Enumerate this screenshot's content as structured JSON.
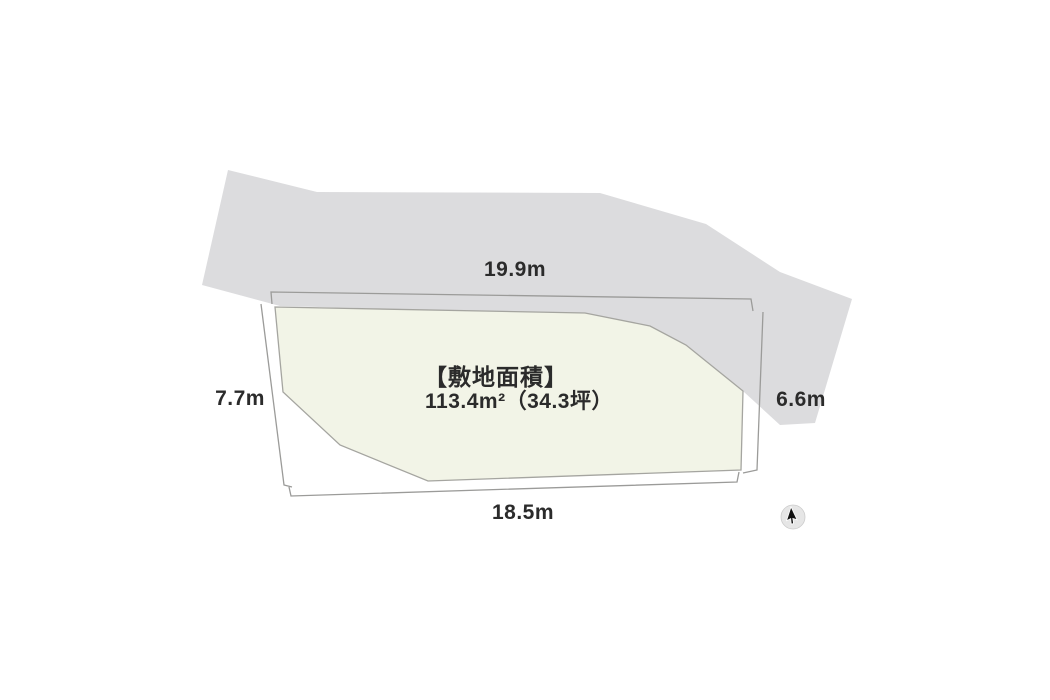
{
  "diagram": {
    "type": "land-plot-survey-diagram",
    "area_title": "【敷地面積】",
    "area_value": "113.4m²（34.3坪）",
    "dimensions": {
      "top": "19.9m",
      "left": "7.7m",
      "right": "6.6m",
      "bottom": "18.5m"
    },
    "icons": {
      "cursor": "mouse-cursor-icon"
    },
    "colors": {
      "background": "#ffffff",
      "road_fill": "#dcdcde",
      "plot_fill": "#f2f4e7",
      "plot_stroke": "#a5a5a0",
      "dimension_line": "#9b9b99",
      "text": "#2b2b2b",
      "cursor_circle": "#e6e6e6",
      "cursor_arrow": "#111111"
    }
  }
}
